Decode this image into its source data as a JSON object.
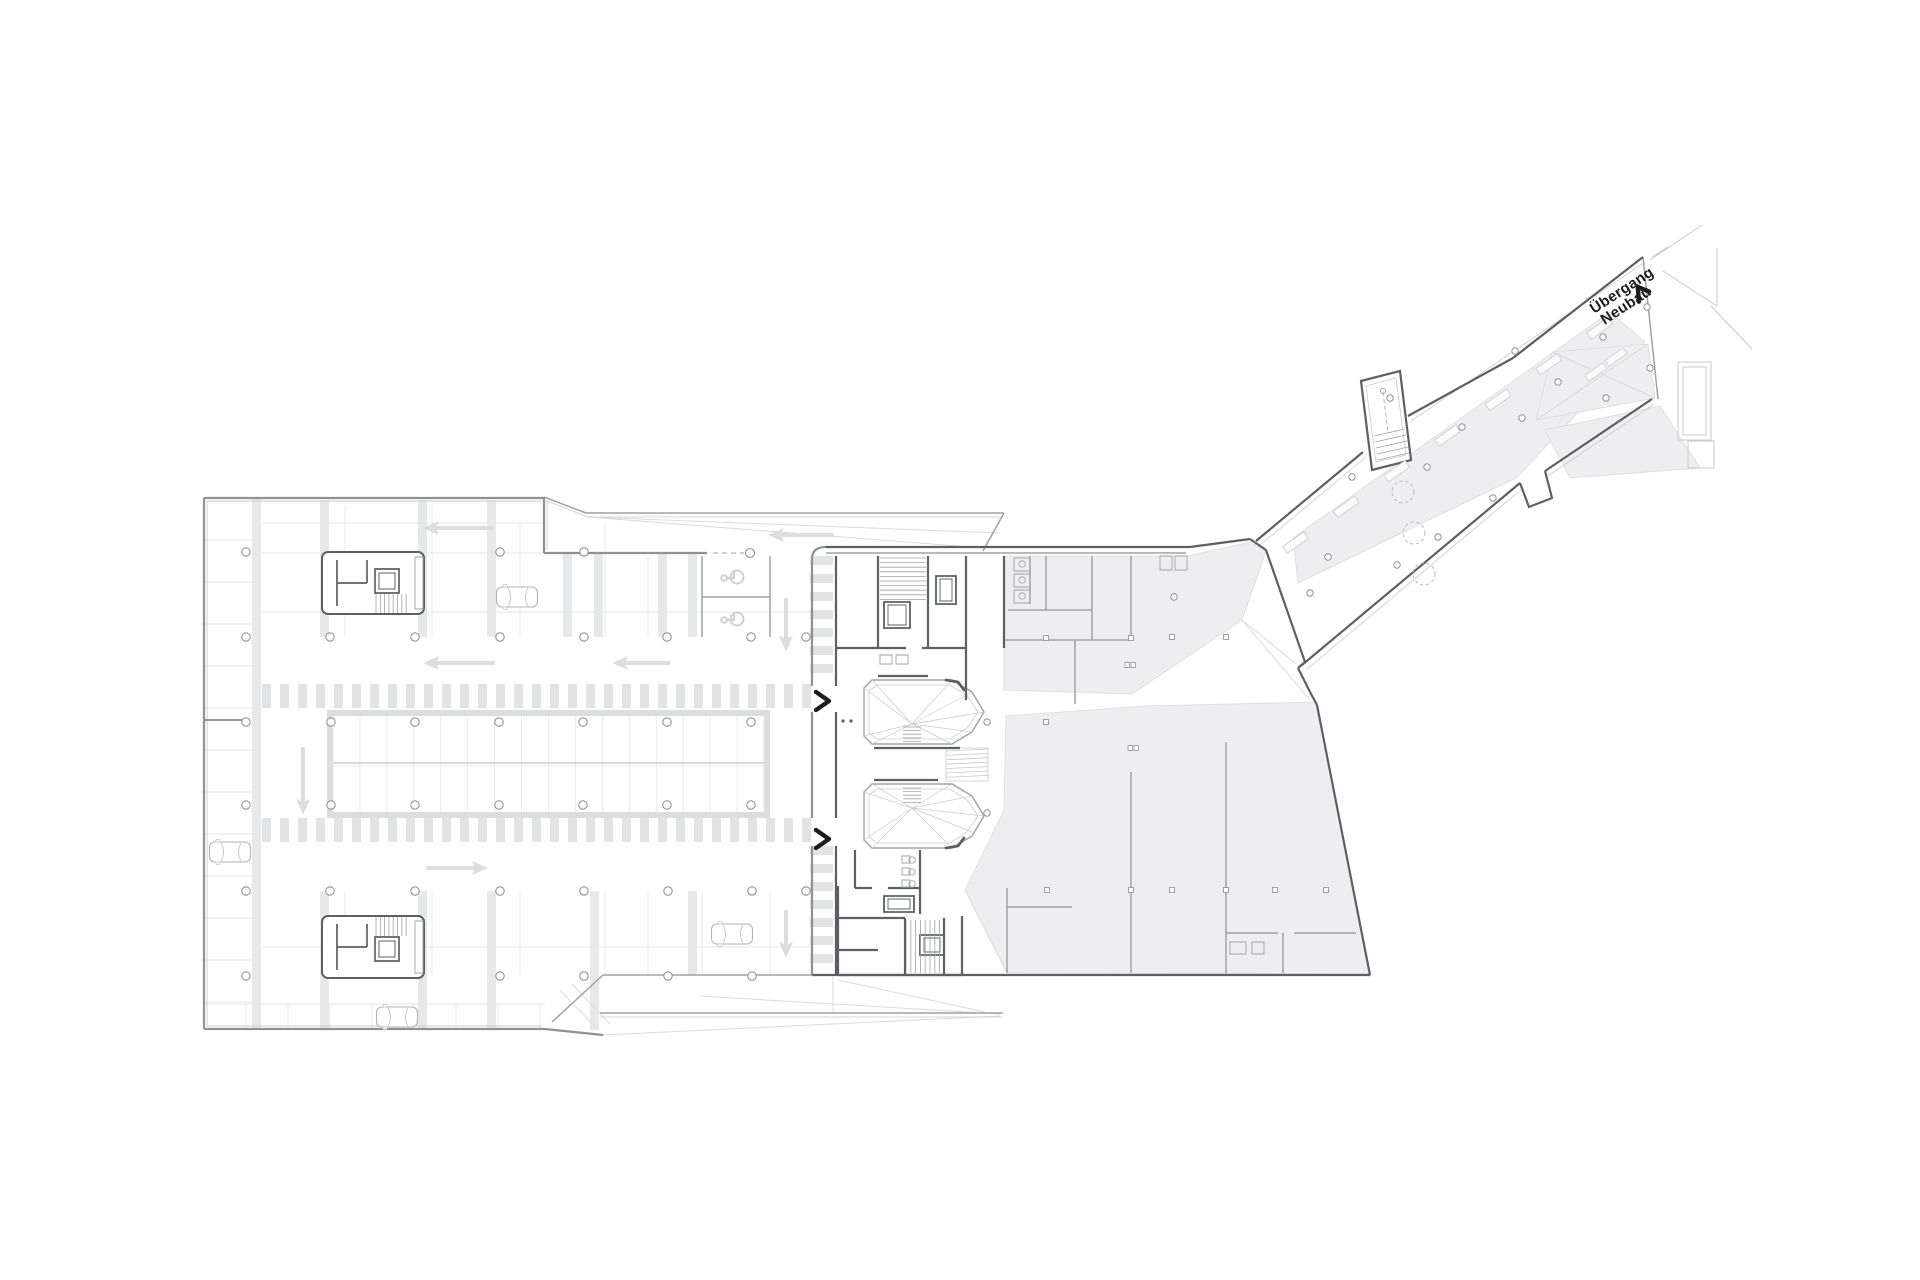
{
  "label": {
    "line1": "Übergang",
    "line2": "Neubau"
  },
  "colors": {
    "ink": "#1c1c1e",
    "wall": "#8f9295",
    "wall_dark": "#5c6064",
    "wall_medium": "#9fa2a5",
    "grid_light": "#e5e6e8",
    "grid_faint": "#dadbdd",
    "pillar_band": "#e7e8ea",
    "hatch": "#e2e3e5",
    "floor_gray": "#eeeef0",
    "traffic_arrow": "#dcddde",
    "context": "#c8cacc",
    "thin_line": "#c9cbcd",
    "tree": "#b5b7b9"
  },
  "canvas": {
    "w": 1920,
    "h": 1280
  },
  "layers": {
    "gray_fills": [
      {
        "name": "upper-hall-floor",
        "pts": "1004,556 1188,556 1250,542 1266,551 1242,620 1132,694 1004,690"
      },
      {
        "name": "lower-hall-floor",
        "pts": "1006,716 1146,706 1317,702 1370,974 1007,973 965,890 1004,810"
      },
      {
        "name": "corridor-ramp-band",
        "pts": "1293,538 1610,312 1645,342 1516,478 1298,583"
      },
      {
        "name": "corridor-end-fan",
        "pts": "1552,352 1648,344 1655,398 1536,420"
      },
      {
        "name": "outside-plaza-patch",
        "pts": "1545,430 1660,406 1700,468 1570,478"
      }
    ],
    "outer_walls": [
      "M204,498 H544",
      "M204,498 V1029",
      "M204,1029 H545",
      "M544,497 V553",
      "M544,553 H707",
      "M812,559 V686",
      "M812,712 V818",
      "M812,846 V975",
      "M812,559 Q812,547 826,547",
      "M545,1029 L603,1035"
    ],
    "inner_wall_lines": [
      "M207,501 H541",
      "M207,501 V1026",
      "M207,1026 H542",
      "M547,500 V550"
    ],
    "dark_walls": [
      "M826,547 H1190",
      "M1190,547 L1250,539",
      "M1250,539 L1266,550",
      "M836,556 V686",
      "M836,712 V818",
      "M836,846 V975",
      "M878,556 V648",
      "M928,556 V648",
      "M966,556 V700",
      "M1004,556 V648",
      "M836,648 H906",
      "M922,648 H966",
      "M878,676 H928",
      "M838,886 V975",
      "M838,918 H905",
      "M838,950 H878",
      "M905,918 V975",
      "M944,918 V975",
      "M962,916 V975",
      "M838,975 H962",
      "M855,850 V888",
      "M920,850 V914",
      "M855,888 H872",
      "M888,888 H920",
      "M874,748 H960",
      "M874,780 H938",
      "M812,975 H1370",
      "M1370,975 L1317,705",
      "M1317,705 L1310,692",
      "M1310,692 L1298,668",
      "M1298,668 L1305,662",
      "M1305,662 L1266,550",
      "M1256,541 L1363,452",
      "M1408,416 L1513,358",
      "M1513,358 L1643,257",
      "M1302,665 L1520,483",
      "M1545,471 L1652,399",
      "M1520,483 L1529,507 L1552,498 L1545,471"
    ],
    "medium_walls": [
      "M826,553 H1186",
      "M603,975 L552,1022",
      "M603,975 H812",
      "M1046,556 V610",
      "M1092,556 V640",
      "M1008,610 H1092",
      "M1004,640 H1131",
      "M1131,556 V638",
      "M1075,640 V704",
      "M1007,888 V973",
      "M1007,907 H1072",
      "M1131,772 V973",
      "M1226,742 V973",
      "M1226,933 H1278",
      "M1294,933 H1356",
      "M1283,933 V973",
      "M1030,556 V604",
      "M702,556 V637",
      "M770,556 V637",
      "M702,597 H770",
      "M1643,257 L1658,399",
      "M600,1013 H1003",
      "M544,497 L586,513",
      "M586,513 H1004",
      "M1004,513 L983,551"
    ],
    "thin_lines": [
      "M547,501 L588,517",
      "M588,517 H1001",
      "M600,1017 H1003",
      "M1259,546 L1366,457",
      "M1411,421 L1645,262",
      "M1306,670 L1523,488",
      "M1548,476 L1654,404"
    ],
    "light_lines": [
      "M262,523 H544",
      "M262,553 H544",
      "M262,612 H811",
      "M262,947 H811",
      "M204,1004 H545",
      "M345,505 V637",
      "M432,505 V637",
      "M520,523 V637",
      "M605,523 V637",
      "M648,556 V637",
      "M345,891 V975",
      "M432,891 V975",
      "M520,891 V975",
      "M605,891 V975",
      "M648,891 V975",
      "M702,891 V975",
      "M770,891 V975",
      "M246,1004 V1029",
      "M288,1004 V1029",
      "M330,1004 V1029",
      "M372,1004 V1029",
      "M414,1004 V1029",
      "M456,1004 V1029",
      "M498,1004 V1029",
      "M540,1004 V1029"
    ],
    "faint_lines": [
      "M588,517 L983,548",
      "M588,517 L1000,533",
      "M603,1035 L1000,1016",
      "M833,975 L833,1013",
      "M838,980 L985,1012",
      "M700,996 L1000,1014",
      "M560,990 L598,1030",
      "M572,984 L610,1024",
      "M1242,620 L1310,700",
      "M1242,620 L1296,664",
      "M1552,352 L1655,398",
      "M1536,420 L1648,344",
      "M965,890 L1007,973"
    ],
    "context_lines": [
      "M1652,257 L1668,247",
      "M1650,260 L1702,225",
      "M1663,271 L1717,306",
      "M1717,248 V306",
      "M1711,306 L1752,349"
    ],
    "context_rects": [
      [
        1678,
        362,
        33,
        78
      ],
      [
        1683,
        367,
        23,
        68
      ],
      [
        1688,
        441,
        26,
        27
      ]
    ]
  },
  "structures": {
    "left_strip": {
      "x1": 204,
      "x2": 252,
      "y1": 540,
      "y2": 1008,
      "step": 42
    },
    "pillar_bands": [
      [
        252,
        498,
        9,
        531
      ],
      [
        320,
        500,
        9,
        137
      ],
      [
        418,
        500,
        9,
        137
      ],
      [
        487,
        500,
        9,
        137
      ],
      [
        563,
        553,
        9,
        84
      ],
      [
        594,
        553,
        9,
        84
      ],
      [
        658,
        553,
        9,
        84
      ],
      [
        688,
        553,
        9,
        84
      ],
      [
        320,
        891,
        9,
        139
      ],
      [
        418,
        891,
        9,
        139
      ],
      [
        487,
        891,
        9,
        139
      ],
      [
        590,
        891,
        9,
        139
      ],
      [
        688,
        891,
        9,
        84
      ]
    ],
    "hatch_bands": [
      {
        "x": 262,
        "y": 684,
        "w": 549,
        "h": 24,
        "dir": "v",
        "bar": 9,
        "gap": 9
      },
      {
        "x": 262,
        "y": 818,
        "w": 549,
        "h": 24,
        "dir": "v",
        "bar": 9,
        "gap": 9
      },
      {
        "x": 810,
        "y": 556,
        "w": 23,
        "h": 128,
        "dir": "h",
        "bar": 9,
        "gap": 9
      },
      {
        "x": 810,
        "y": 846,
        "w": 23,
        "h": 122,
        "dir": "h",
        "bar": 9,
        "gap": 9
      }
    ],
    "strip": {
      "x": 327,
      "y": 710,
      "w": 443,
      "h": 108,
      "cap": 6,
      "stalls": 16
    },
    "stair_cores": [
      {
        "x": 322,
        "y": 552,
        "w": 102,
        "h": 62,
        "flip": false
      },
      {
        "x": 322,
        "y": 916,
        "w": 102,
        "h": 62,
        "flip": true
      }
    ],
    "elevators": [
      [
        884,
        602,
        26,
        26
      ],
      [
        936,
        576,
        20,
        28
      ],
      [
        884,
        896,
        30,
        16
      ],
      [
        920,
        935,
        24,
        20
      ]
    ],
    "tread_banks": [
      {
        "x": 880,
        "y": 558,
        "w": 46,
        "h": 42,
        "dir": "h",
        "step": 4.6
      },
      {
        "x": 906,
        "y": 920,
        "w": 38,
        "h": 53,
        "dir": "v",
        "step": 4.8
      }
    ],
    "atria": [
      {
        "outer": "M872,680 L952,680 L972,692 L984,712 L972,732 L952,744 L872,744 L864,736 L864,688 Z",
        "inner": "M877,685 L950,685 L967,696 L978,712 L967,728 L950,739 L877,739 L869,733 L869,691 Z",
        "hub": [
          912,
          724
        ],
        "verts": [
          [
            872,
            680
          ],
          [
            952,
            680
          ],
          [
            972,
            692
          ],
          [
            984,
            712
          ],
          [
            972,
            732
          ],
          [
            952,
            744
          ],
          [
            872,
            744
          ],
          [
            864,
            736
          ],
          [
            864,
            688
          ]
        ],
        "stair": {
          "x": 903,
          "y": 727,
          "w": 18,
          "h": 17,
          "step": 3.6
        },
        "corner": "M946,680 L958,682 L964,690"
      },
      {
        "outer": "M872,784 L952,784 L972,796 L984,816 L972,836 L952,848 L872,848 L864,840 L864,792 Z",
        "inner": "M877,789 L950,789 L967,800 L978,816 L967,832 L950,843 L877,843 L869,837 L869,795 Z",
        "hub": [
          912,
          808
        ],
        "verts": [
          [
            872,
            784
          ],
          [
            952,
            784
          ],
          [
            972,
            796
          ],
          [
            984,
            816
          ],
          [
            972,
            832
          ],
          [
            952,
            848
          ],
          [
            872,
            848
          ],
          [
            864,
            840
          ],
          [
            864,
            792
          ]
        ],
        "stair": {
          "x": 903,
          "y": 788,
          "w": 18,
          "h": 17,
          "step": 3.6
        },
        "corner": "M946,848 L958,846 L964,838"
      }
    ],
    "mid_ramp": {
      "x": 946,
      "y": 748,
      "w": 42,
      "h": 33,
      "lines": 7
    },
    "annex": {
      "outer": "M1361,381 L1400,371 L1411,460 L1372,470 Z",
      "inner": "M1366,386 L1396,378 L1406,455 L1376,462 Z",
      "treads": [
        "M1374,436 L1405,429",
        "M1375,442 L1406,435",
        "M1376,448 L1407,441",
        "M1377,454 L1408,447",
        "M1378,460 L1409,453"
      ],
      "dash": "M1383,392 L1388,432",
      "circle": [
        1383,
        391
      ]
    },
    "slat_rows": [
      {
        "from": [
          1288,
          532
        ],
        "to": [
          1592,
          318
        ],
        "count": 7,
        "off": [
          7.5,
          10.6
        ],
        "w": 26,
        "h": 8,
        "rot": -35
      },
      {
        "from": [
          1596,
          372
        ],
        "to": [
          1616,
          357
        ],
        "count": 2,
        "off": [
          0,
          0
        ],
        "w": 22,
        "h": 7,
        "rot": -35
      }
    ]
  },
  "items": {
    "cars": [
      [
        517,
        597
      ],
      [
        230,
        852
      ],
      [
        732,
        934
      ],
      [
        397,
        1017
      ]
    ],
    "arrows": [
      {
        "tip": [
          768,
          535
        ],
        "dir": "left",
        "len": 66
      },
      {
        "tip": [
          423,
          528
        ],
        "dir": "left",
        "len": 70
      },
      {
        "tip": [
          423,
          663
        ],
        "dir": "left",
        "len": 72
      },
      {
        "tip": [
          612,
          663
        ],
        "dir": "left",
        "len": 58
      },
      {
        "tip": [
          488,
          868
        ],
        "dir": "right",
        "len": 62
      },
      {
        "tip": [
          303,
          815
        ],
        "dir": "down",
        "len": 68
      },
      {
        "tip": [
          786,
          652
        ],
        "dir": "down",
        "len": 54
      },
      {
        "tip": [
          786,
          958
        ],
        "dir": "down",
        "len": 48
      }
    ],
    "chevrons": [
      [
        816,
        701
      ],
      [
        816,
        839
      ]
    ],
    "entry_dash": {
      "line": [
        713,
        553,
        744,
        553
      ],
      "circle": [
        750,
        553
      ]
    },
    "beam": {
      "line": [
        204,
        720,
        247,
        720
      ]
    },
    "round_columns": [
      [
        246,
        552
      ],
      [
        500,
        552
      ],
      [
        584,
        552
      ],
      [
        246,
        637
      ],
      [
        330,
        637
      ],
      [
        415,
        637
      ],
      [
        500,
        637
      ],
      [
        584,
        637
      ],
      [
        667,
        637
      ],
      [
        751,
        637
      ],
      [
        806,
        637
      ],
      [
        246,
        722
      ],
      [
        331,
        722
      ],
      [
        415,
        722
      ],
      [
        499,
        722
      ],
      [
        583,
        722
      ],
      [
        667,
        722
      ],
      [
        751,
        722
      ],
      [
        246,
        805
      ],
      [
        331,
        805
      ],
      [
        415,
        805
      ],
      [
        499,
        805
      ],
      [
        583,
        805
      ],
      [
        667,
        805
      ],
      [
        751,
        805
      ],
      [
        246,
        891
      ],
      [
        330,
        891
      ],
      [
        415,
        891
      ],
      [
        500,
        891
      ],
      [
        584,
        891
      ],
      [
        668,
        891
      ],
      [
        752,
        891
      ],
      [
        806,
        891
      ],
      [
        246,
        976
      ],
      [
        500,
        976
      ],
      [
        584,
        976
      ],
      [
        668,
        976
      ],
      [
        752,
        976
      ]
    ],
    "plaza_columns": [
      [
        987,
        722
      ],
      [
        987,
        813
      ],
      [
        1174,
        597
      ],
      [
        1310,
        593
      ],
      [
        1328,
        557
      ],
      [
        1352,
        477
      ],
      [
        1390,
        398
      ],
      [
        1397,
        565
      ],
      [
        1427,
        467
      ],
      [
        1438,
        537
      ],
      [
        1462,
        427
      ],
      [
        1493,
        498
      ],
      [
        1515,
        351
      ],
      [
        1522,
        418
      ],
      [
        1558,
        382
      ],
      [
        1603,
        337
      ],
      [
        1647,
        307
      ],
      [
        1650,
        368
      ],
      [
        1606,
        398
      ]
    ],
    "square_columns": [
      [
        1046,
        638
      ],
      [
        1131,
        638
      ],
      [
        1172,
        637
      ],
      [
        1226,
        637
      ],
      [
        1046,
        722
      ],
      [
        1047,
        890
      ],
      [
        1131,
        890
      ],
      [
        1172,
        890
      ],
      [
        1226,
        890
      ],
      [
        1275,
        890
      ],
      [
        1326,
        890
      ]
    ],
    "double_squares": [
      [
        1130,
        665
      ],
      [
        1133,
        748
      ]
    ],
    "trees": [
      [
        1403,
        492
      ],
      [
        1414,
        533
      ],
      [
        1424,
        574
      ]
    ],
    "accessible": [
      [
        733,
        578
      ],
      [
        733,
        620
      ]
    ],
    "dots": [
      [
        843,
        721
      ],
      [
        851,
        721
      ]
    ],
    "fixture_rects": [
      [
        1230,
        942,
        16,
        12
      ],
      [
        1252,
        942,
        12,
        12
      ],
      [
        1160,
        556,
        12,
        14
      ],
      [
        1175,
        556,
        12,
        14
      ],
      [
        1014,
        558,
        16,
        13
      ],
      [
        1014,
        574,
        16,
        13
      ],
      [
        1014,
        590,
        16,
        13
      ],
      [
        880,
        655,
        12,
        9
      ],
      [
        896,
        655,
        12,
        9
      ],
      [
        902,
        856,
        8,
        7
      ],
      [
        902,
        868,
        8,
        7
      ],
      [
        902,
        880,
        8,
        7
      ]
    ],
    "fixture_circles": [
      [
        912,
        860
      ],
      [
        912,
        872
      ],
      [
        912,
        884
      ],
      [
        1022,
        564
      ],
      [
        1022,
        580
      ],
      [
        1022,
        596
      ]
    ]
  }
}
